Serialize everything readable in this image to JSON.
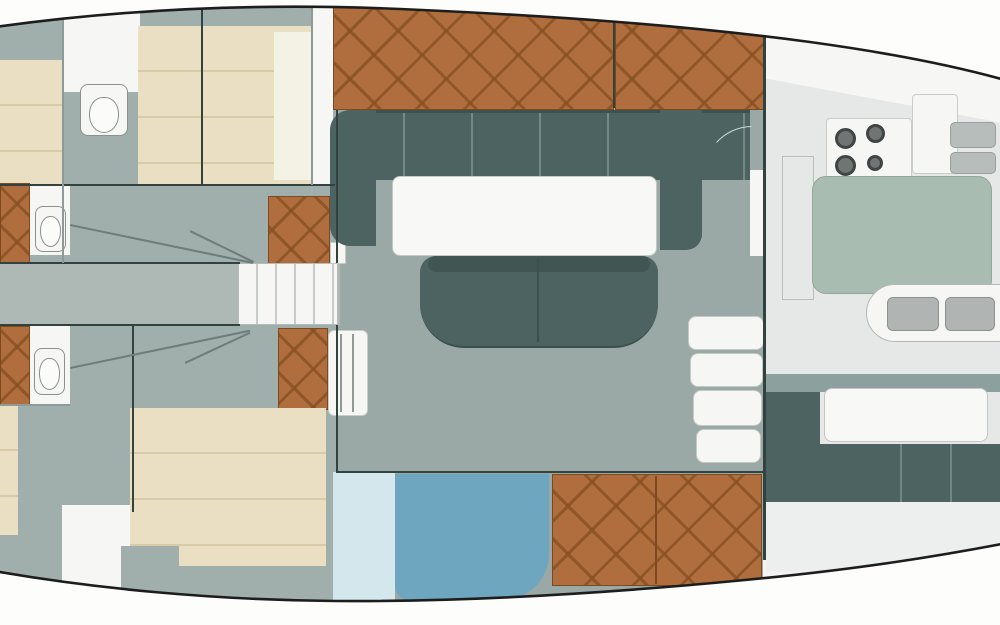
{
  "meta": {
    "description": "Top-down interior deck plan of a sailing yacht with forward cabins, heads, salon, galley and aft dinette",
    "plan_type": "yacht-interior-floor-plan"
  },
  "colors": {
    "hullStroke": "#1d1d1d",
    "floorGray": "#a0aeac",
    "floorSalon": "#9aa8a6",
    "corridor": "#aeb9b6",
    "teal": "#4d6361",
    "tealDark": "#3d5250",
    "cream": "#eadfc2",
    "creamSeam": "#d9cba8",
    "wood": "#b06e3f",
    "woodLine": "#875022cc",
    "white": "#f6f6f4",
    "galleyBase": "#f3f4f2",
    "galleyFloor": "#e6e8e7",
    "sage": "#a9bcb1",
    "sageBorder": "#90a79a",
    "blueLight": "#d4e7ed",
    "blueMid": "#6fa6bf",
    "basin": "#b0b5b4",
    "wall": "#31423f",
    "lineLight": "#8d9a97"
  },
  "regions": [
    {
      "id": "forward-cabin-upper",
      "items": [
        "double-berth",
        "pillow",
        "head-toilet",
        "wood-sole-hatch"
      ]
    },
    {
      "id": "forward-cabin-lower",
      "items": [
        "double-berth",
        "head-toilet",
        "wood-sole-hatch"
      ]
    },
    {
      "id": "center-corridor",
      "items": [
        "steps",
        "sliding-door-lines",
        "wood-sole-hatches",
        "wardrobe-locker"
      ]
    },
    {
      "id": "salon",
      "items": [
        "u-settee",
        "dining-table",
        "center-bench",
        "cabin-top-wood-hatches",
        "door-arc"
      ]
    },
    {
      "id": "aft-compartment-port",
      "items": [
        "pale-panel",
        "blue-berth-cushion",
        "wood-sole-hatch"
      ]
    },
    {
      "id": "galley",
      "items": [
        "stove-four-burner",
        "counter-island",
        "double-sink",
        "companionway-steps"
      ]
    },
    {
      "id": "aft-dinette",
      "items": [
        "table",
        "bench-seat-band",
        "seat-back"
      ]
    }
  ]
}
